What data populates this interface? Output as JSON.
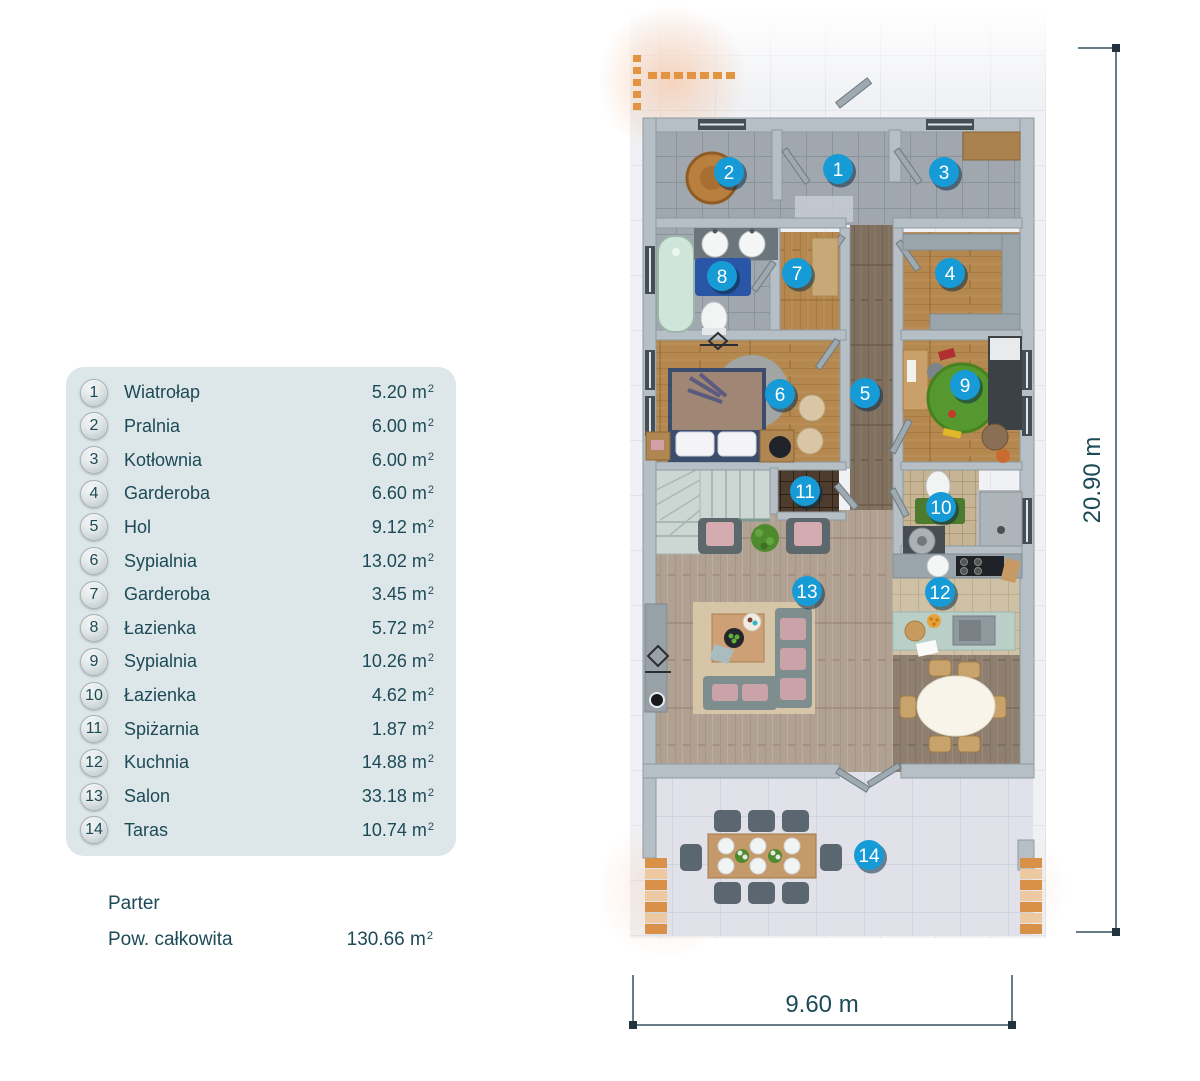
{
  "legend": {
    "unit_base": "m",
    "unit_sup": "2",
    "items": [
      {
        "num": "1",
        "name": "Wiatrołap",
        "area": "5.20"
      },
      {
        "num": "2",
        "name": "Pralnia",
        "area": "6.00"
      },
      {
        "num": "3",
        "name": "Kotłownia",
        "area": "6.00"
      },
      {
        "num": "4",
        "name": "Garderoba",
        "area": "6.60"
      },
      {
        "num": "5",
        "name": "Hol",
        "area": "9.12"
      },
      {
        "num": "6",
        "name": "Sypialnia",
        "area": "13.02"
      },
      {
        "num": "7",
        "name": "Garderoba",
        "area": "3.45"
      },
      {
        "num": "8",
        "name": "Łazienka",
        "area": "5.72"
      },
      {
        "num": "9",
        "name": "Sypialnia",
        "area": "10.26"
      },
      {
        "num": "10",
        "name": "Łazienka",
        "area": "4.62"
      },
      {
        "num": "11",
        "name": "Spiżarnia",
        "area": "1.87"
      },
      {
        "num": "12",
        "name": "Kuchnia",
        "area": "14.88"
      },
      {
        "num": "13",
        "name": "Salon",
        "area": "33.18"
      },
      {
        "num": "14",
        "name": "Taras",
        "area": "10.74"
      }
    ],
    "floor_label": "Parter",
    "total_label": "Pow. całkowita",
    "total_area": "130.66"
  },
  "plan": {
    "dim_height": {
      "label": "20.90 m"
    },
    "dim_width": {
      "label": "9.60 m"
    },
    "markers": [
      {
        "n": "1",
        "x": 838,
        "y": 169
      },
      {
        "n": "2",
        "x": 729,
        "y": 172
      },
      {
        "n": "3",
        "x": 944,
        "y": 172
      },
      {
        "n": "4",
        "x": 950,
        "y": 273
      },
      {
        "n": "5",
        "x": 865,
        "y": 393
      },
      {
        "n": "6",
        "x": 780,
        "y": 394
      },
      {
        "n": "7",
        "x": 797,
        "y": 273
      },
      {
        "n": "8",
        "x": 722,
        "y": 276
      },
      {
        "n": "9",
        "x": 965,
        "y": 385
      },
      {
        "n": "10",
        "x": 941,
        "y": 507
      },
      {
        "n": "11",
        "x": 805,
        "y": 491
      },
      {
        "n": "12",
        "x": 940,
        "y": 592
      },
      {
        "n": "13",
        "x": 807,
        "y": 591
      },
      {
        "n": "14",
        "x": 869,
        "y": 855
      }
    ]
  },
  "colors": {
    "marker_fill": "#179bd6",
    "marker_shadow": "rgba(10,45,70,0.55)",
    "legend_text": "#1d4a57",
    "dim_line": "#35505c"
  }
}
